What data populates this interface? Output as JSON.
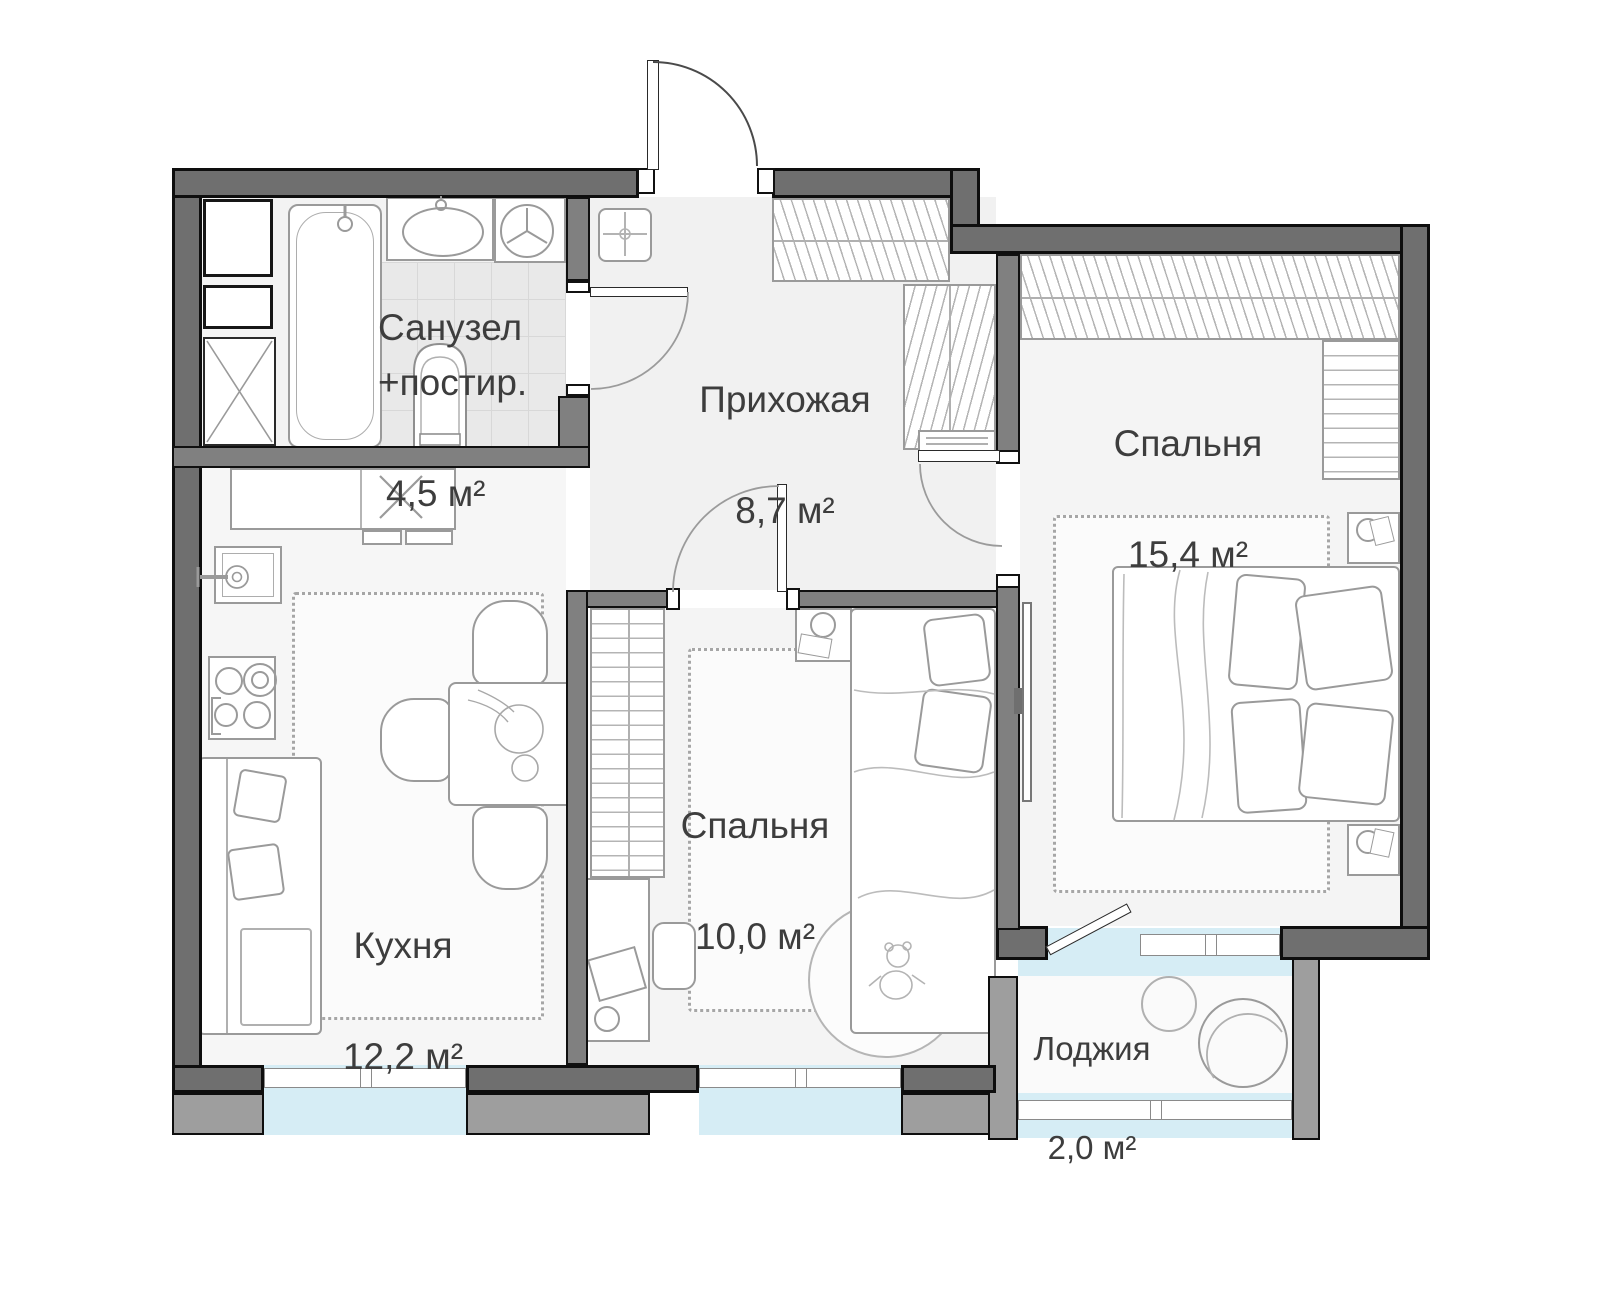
{
  "plan": {
    "type": "apartment-floor-plan",
    "rooms": [
      {
        "id": "bathroom",
        "name": "Санузел\n+постир.",
        "area": "4,5 м²"
      },
      {
        "id": "hallway",
        "name": "Прихожая",
        "area": "8,7 м²"
      },
      {
        "id": "bedroom-main",
        "name": "Спальня",
        "area": "15,4 м²"
      },
      {
        "id": "bedroom-small",
        "name": "Спальня",
        "area": "10,0 м²"
      },
      {
        "id": "kitchen",
        "name": "Кухня",
        "area": "12,2 м²"
      },
      {
        "id": "loggia",
        "name": "Лоджия",
        "area": "2,0 м²"
      }
    ],
    "colors": {
      "wall": "#6f6f6f",
      "wall_light": "#9e9e9e",
      "glazing": "#d6edf5",
      "outline": "#0e0e0e",
      "furniture_stroke": "#9a9a9a",
      "label_text": "#3d3d3d"
    },
    "fixtures": [
      "bathtub",
      "sink",
      "washing-machine",
      "toilet",
      "ventilation-shaft",
      "entrance-door",
      "wardrobe",
      "floor-drain",
      "kitchen-counter",
      "kitchen-sink",
      "stove",
      "dining-table",
      "chair",
      "sofa",
      "single-bed",
      "double-bed",
      "nightstand",
      "lamp",
      "desk",
      "tv",
      "round-rug",
      "teddy-bear",
      "loggia-chairs"
    ]
  }
}
